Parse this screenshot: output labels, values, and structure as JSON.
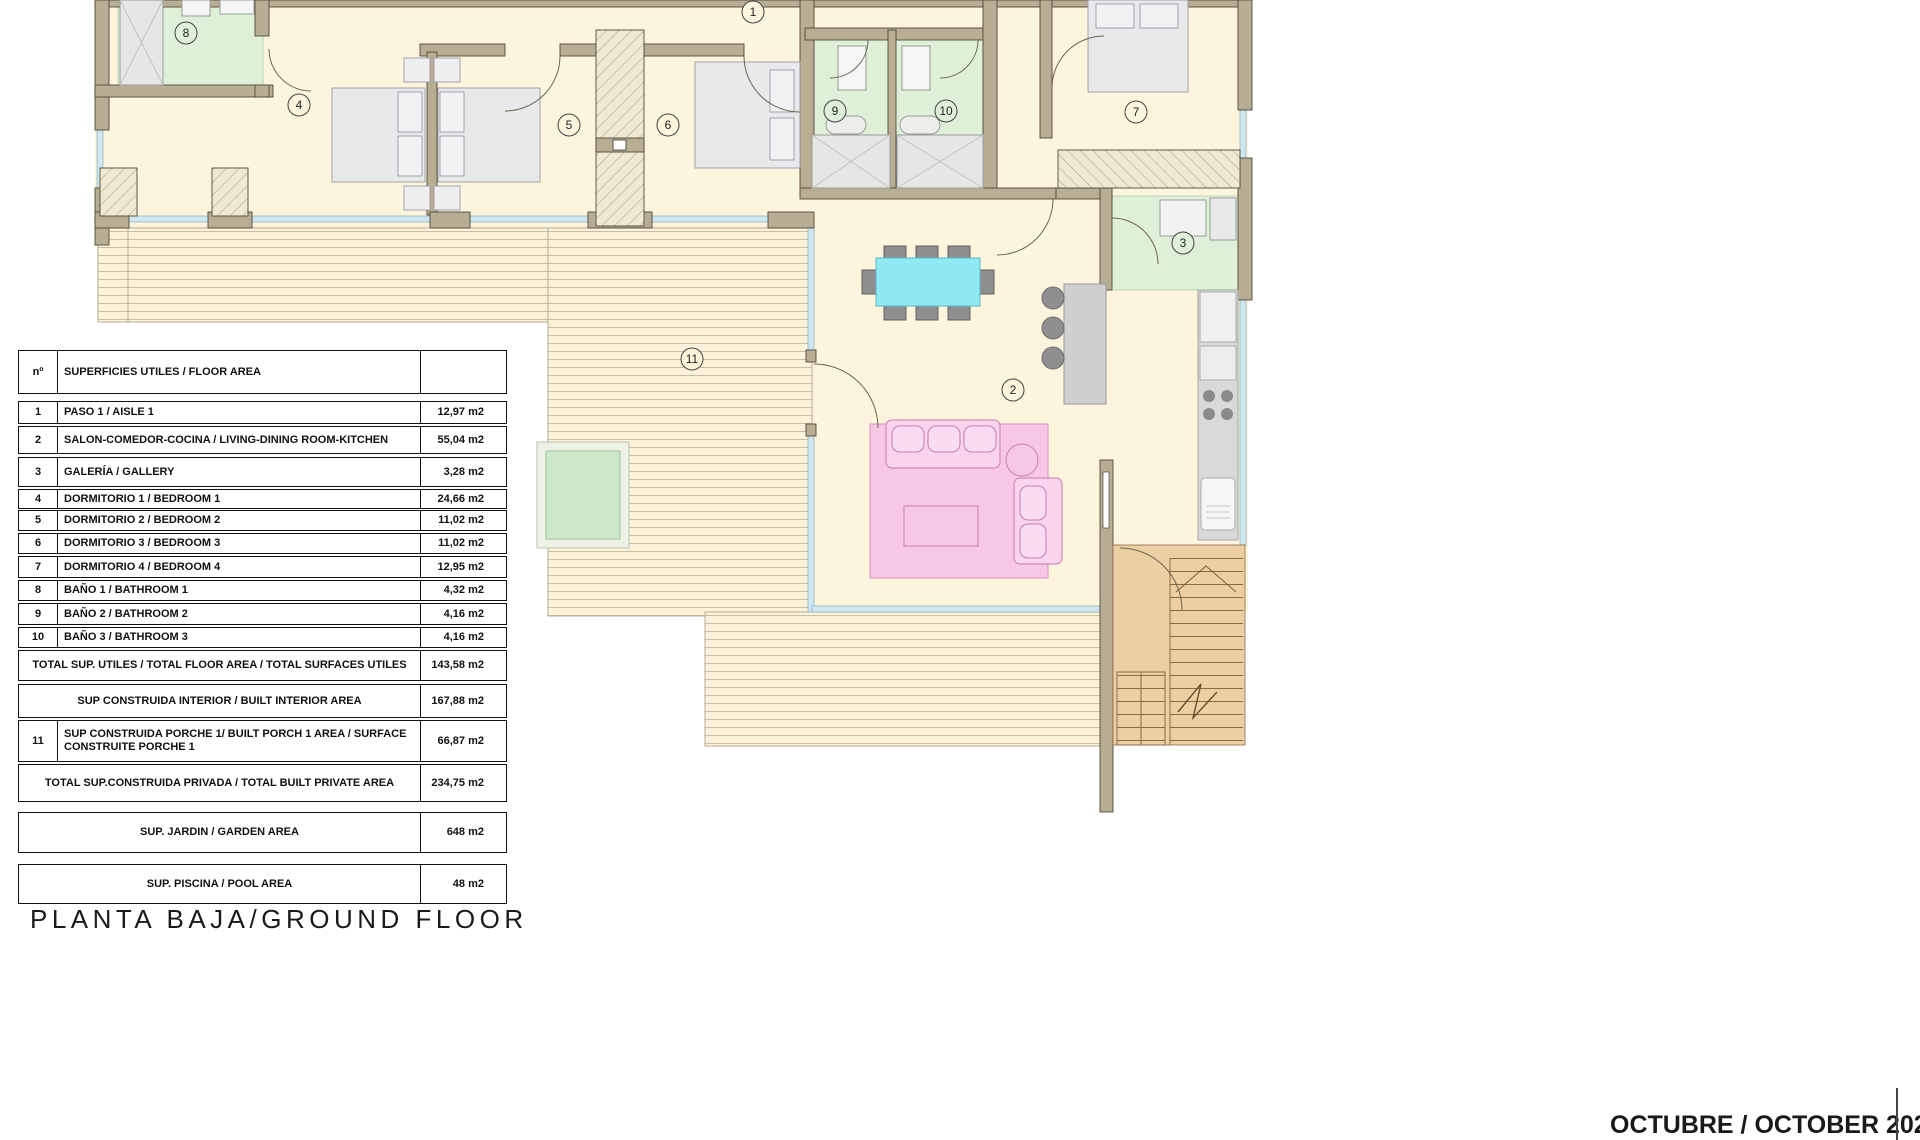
{
  "page": {
    "title": "PLANTA BAJA/GROUND FLOOR",
    "date": "OCTUBRE / OCTOBER 2024"
  },
  "table": {
    "header": {
      "num": "nº",
      "label": "SUPERFICIES UTILES / FLOOR AREA"
    },
    "rows": [
      {
        "num": "1",
        "label": "PASO 1 / AISLE 1",
        "value": "12,97 m2"
      },
      {
        "num": "2",
        "label": "SALON-COMEDOR-COCINA /  LIVING-DINING ROOM-KITCHEN",
        "value": "55,04 m2"
      },
      {
        "num": "3",
        "label": "GALERÍA / GALLERY",
        "value": "3,28 m2"
      },
      {
        "num": "4",
        "label": "DORMITORIO 1 / BEDROOM 1",
        "value": "24,66 m2"
      },
      {
        "num": "5",
        "label": "DORMITORIO 2 / BEDROOM 2",
        "value": "11,02 m2"
      },
      {
        "num": "6",
        "label": "DORMITORIO 3 / BEDROOM 3",
        "value": "11,02 m2"
      },
      {
        "num": "7",
        "label": "DORMITORIO 4 / BEDROOM 4",
        "value": "12,95 m2"
      },
      {
        "num": "8",
        "label": "BAÑO 1 / BATHROOM 1",
        "value": "4,32 m2"
      },
      {
        "num": "9",
        "label": "BAÑO 2 / BATHROOM 2",
        "value": "4,16 m2"
      },
      {
        "num": "10",
        "label": "BAÑO 3 / BATHROOM 3",
        "value": "4,16 m2"
      }
    ],
    "summary": [
      {
        "label": "TOTAL SUP. UTILES / TOTAL FLOOR AREA / TOTAL SURFACES UTILES",
        "value": "143,58 m2"
      },
      {
        "label": "SUP CONSTRUIDA INTERIOR / BUILT INTERIOR AREA",
        "value": "167,88 m2"
      },
      {
        "num": "11",
        "label": "SUP CONSTRUIDA PORCHE 1/ BUILT PORCH 1 AREA / SURFACE CONSTRUITE PORCHE 1",
        "value": "66,87 m2"
      },
      {
        "label": "TOTAL SUP.CONSTRUIDA PRIVADA / TOTAL  BUILT PRIVATE AREA",
        "value": "234,75 m2"
      }
    ],
    "extra": [
      {
        "label": "SUP. JARDIN / GARDEN AREA",
        "value": "648 m2"
      },
      {
        "label": "SUP. PISCINA / POOL AREA",
        "value": "48 m2"
      }
    ]
  },
  "plan": {
    "rooms": [
      {
        "n": "1"
      },
      {
        "n": "2"
      },
      {
        "n": "3"
      },
      {
        "n": "4"
      },
      {
        "n": "5"
      },
      {
        "n": "6"
      },
      {
        "n": "7"
      },
      {
        "n": "8"
      },
      {
        "n": "9"
      },
      {
        "n": "10"
      },
      {
        "n": "11"
      }
    ],
    "colors": {
      "floor": "#fdf4dd",
      "bath_floor": "#def1d8",
      "wall": "#b7ae94",
      "glass": "#cfe7f0",
      "dining_table": "#8fe9f2",
      "sofa_rug": "#f7c8e6",
      "stairs": "#ecd0a4",
      "pool_water": "#cfe8cb"
    }
  }
}
